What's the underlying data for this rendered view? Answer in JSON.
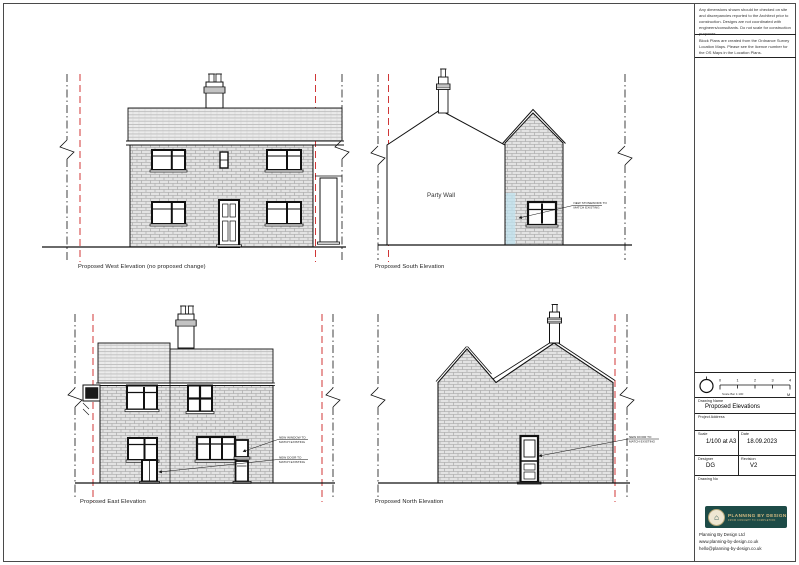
{
  "notes": {
    "disclaimer": "Any dimensions shown should be checked on site and discrepancies reported to the Architect prior to construction. Designs are not coordinated with engineers/consultants. Do not scale for construction purposes.",
    "os_note": "Block Plans are created from the Ordnance Survey Location Maps. Please see the licence number for the OS Maps in the Location Plans."
  },
  "title_block": {
    "scale_bar": {
      "ticks": [
        "0",
        "1",
        "2",
        "3",
        "4"
      ],
      "label": "Scale Bar 1:100",
      "unit": "M"
    },
    "drawing_name_label": "Drawing Name",
    "drawing_name": "Proposed Elevations",
    "project_address_label": "Project Address",
    "project_address": "",
    "scale_label": "Scale",
    "scale_value": "1/100 at A3",
    "date_label": "Date",
    "date_value": "18.09.2023",
    "designer_label": "Designer",
    "designer_value": "DG",
    "revision_label": "Revision",
    "revision_value": "V2",
    "drawing_no_label": "Drawing No",
    "drawing_no_value": ""
  },
  "branding": {
    "logo_text": "PLANNING BY DESIGN",
    "logo_tagline": "FROM CONCEPT TO COMPLETION",
    "company_name": "Planning By Design Ltd",
    "website": "www.planning-by-design.co.uk",
    "email": "hello@planning-by-design.co.uk",
    "logo_bg": "#1d4b47",
    "logo_gold": "#d8bc82",
    "boundary_red": "#cc2222",
    "highlight_blue": "#bfe2ee"
  },
  "elevations": {
    "west": {
      "label": "Proposed West Elevation (no proposed change)"
    },
    "south": {
      "label": "Proposed South Elevation",
      "party_wall": "Party Wall",
      "annotation": {
        "line1": "NEW STONEWORK TO",
        "line2": "MATCH EXISTING"
      }
    },
    "east": {
      "label": "Proposed East Elevation",
      "annotation_window": {
        "line1": "NEW WINDOW TO",
        "line2": "MATCH EXISTING"
      },
      "annotation_door": {
        "line1": "NEW DOOR TO",
        "line2": "MATCH EXISTING"
      }
    },
    "north": {
      "label": "Proposed North Elevation",
      "annotation_door": {
        "line1": "NEW DOOR TO",
        "line2": "MATCH EXISTING"
      }
    }
  }
}
